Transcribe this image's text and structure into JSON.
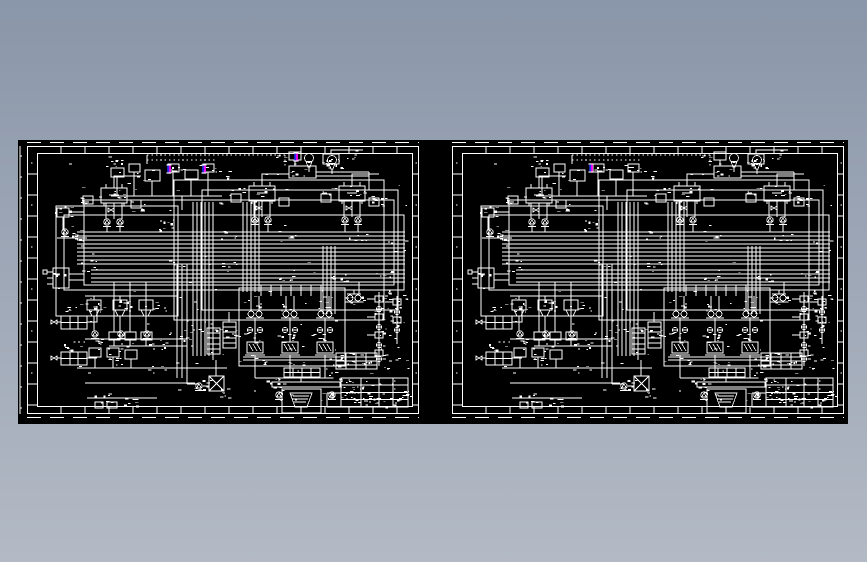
{
  "scene": {
    "description": "CAD model-space preview showing two identical piping-and-instrumentation schematic sheets on a black background",
    "background_top": "#8a96a9",
    "background_bottom": "#b3bac5"
  },
  "canvas": {
    "left": 18,
    "top": 140,
    "width": 830,
    "height": 284,
    "fill": "#000000",
    "line_color": "#ffffff"
  },
  "sheets": [
    {
      "id": "left",
      "label": "schematic-sheet-1",
      "frame_x": 9,
      "frame_y": 6
    },
    {
      "id": "right",
      "label": "schematic-sheet-2",
      "frame_x": 434,
      "frame_y": 6
    }
  ],
  "frame": {
    "width": 392,
    "height": 268,
    "inner": [
      10,
      7,
      386,
      261
    ],
    "side_cell_step": 21,
    "top_cell_step": 24
  },
  "edge_ruler": {
    "x": 2,
    "y1": 6,
    "y2": 274,
    "tick_step": 21
  },
  "cut_marks": {
    "top_y": 2.5,
    "bottom_y": 277.5,
    "dash": "14 9"
  },
  "markers": {
    "blue": "#2a2af0",
    "magenta": "#ff00ff",
    "cap": "#ffffff",
    "positions": {
      "left": [
        {
          "x": 151,
          "y": 29
        },
        {
          "x": 186,
          "y": 29
        },
        {
          "x": 278,
          "y": 17
        }
      ],
      "right": [
        {
          "x": 573,
          "y": 28
        }
      ]
    }
  },
  "texture": {
    "seed": 77,
    "hotspot_dashes": 6,
    "uniform_dashes": 120,
    "blob_count": 85
  }
}
